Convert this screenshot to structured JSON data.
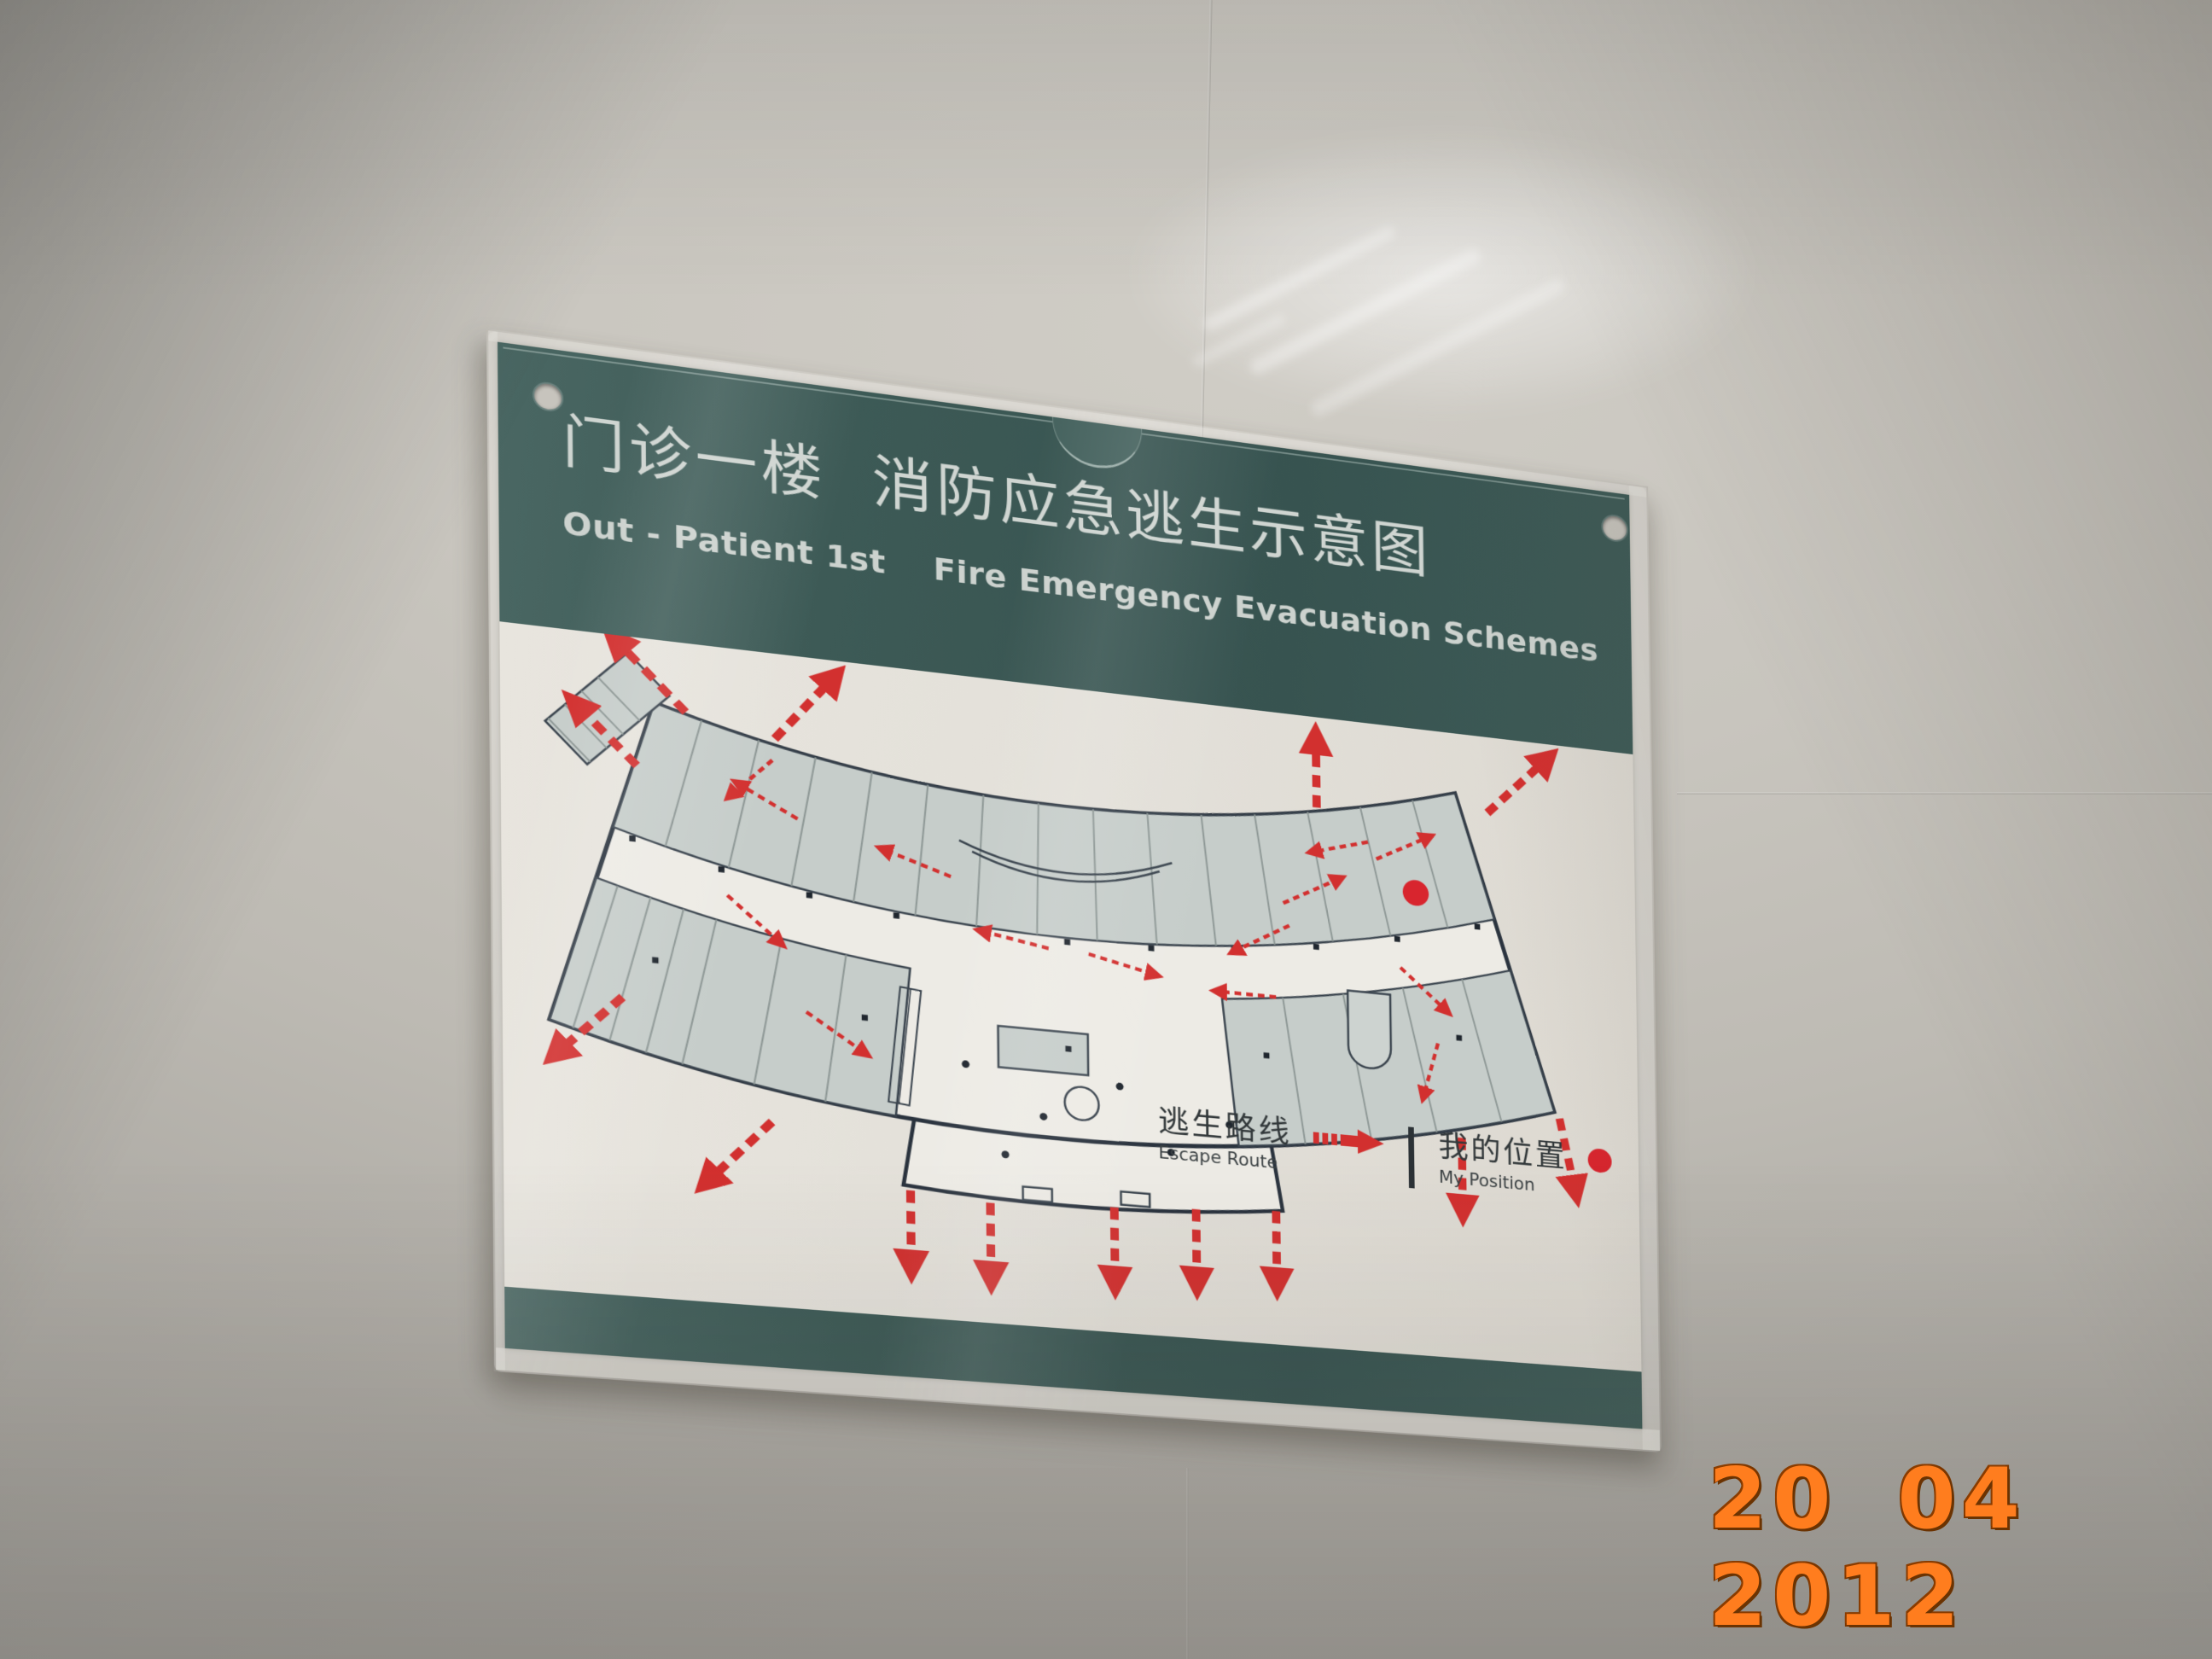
{
  "photo": {
    "camera_date_stamp": "20 04 2012",
    "date_stamp_color": "#ff7d1e"
  },
  "sign": {
    "header": {
      "title_zh": "门诊一楼  消防应急逃生示意图",
      "title_en": "Out - Patient 1st    Fire Emergency Evacuation Schemes"
    },
    "legend": {
      "escape_route_zh": "逃生路线",
      "escape_route_en": "Escape Route",
      "escape_route_icon": "red-dashed-arrow-right",
      "my_position_zh": "我的位置",
      "my_position_en": "My Position",
      "my_position_icon": "red-dot"
    },
    "floor_plan": {
      "kind": "fire-evacuation-floor-plan",
      "building_shape": "curved-arc-outpatient-building",
      "escape_route_color": "#d2302f",
      "my_position_color": "#d8252e"
    },
    "colors": {
      "band_green": "#3d5a56",
      "paper": "#e4e1da",
      "room_gray": "#c6cdca",
      "wall_outline": "#2a333e",
      "title_text": "#cfd5d1"
    }
  }
}
